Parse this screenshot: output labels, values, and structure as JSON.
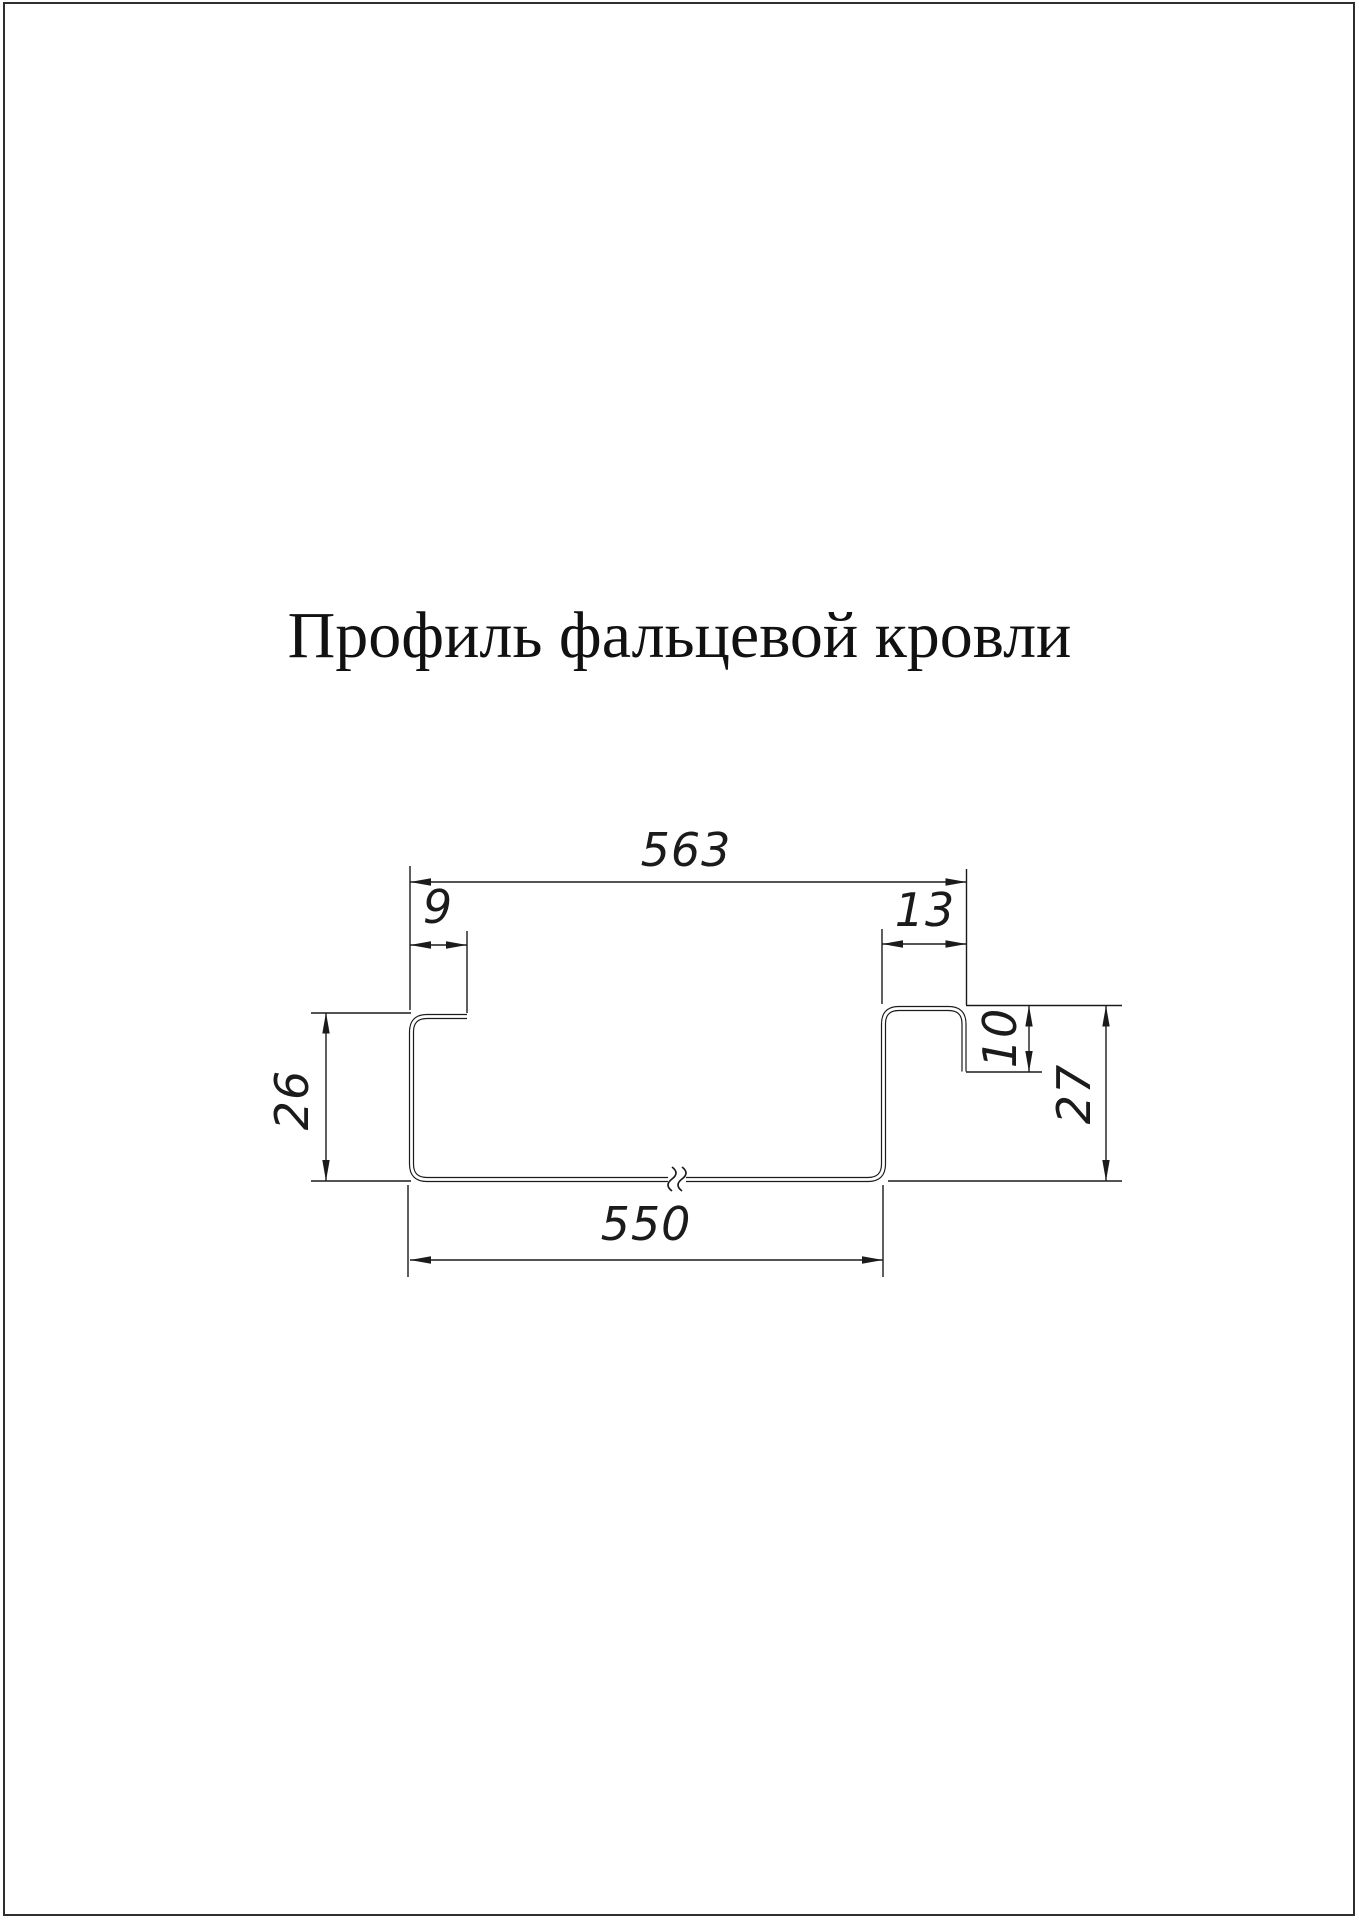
{
  "page": {
    "background": "#ffffff",
    "border_color": "#2e2e2e",
    "line_color": "#1b1b1b",
    "text_color": "#111111"
  },
  "title": "Профиль фальцевой кровли",
  "drawing": {
    "description": "standing-seam-roof-profile-cross-section",
    "dimensions": {
      "overall_top_width": "563",
      "left_lip_width": "9",
      "seam_hook_width": "13",
      "left_height": "26",
      "seam_hook_drop": "10",
      "right_height": "27",
      "bottom_width": "550"
    }
  }
}
